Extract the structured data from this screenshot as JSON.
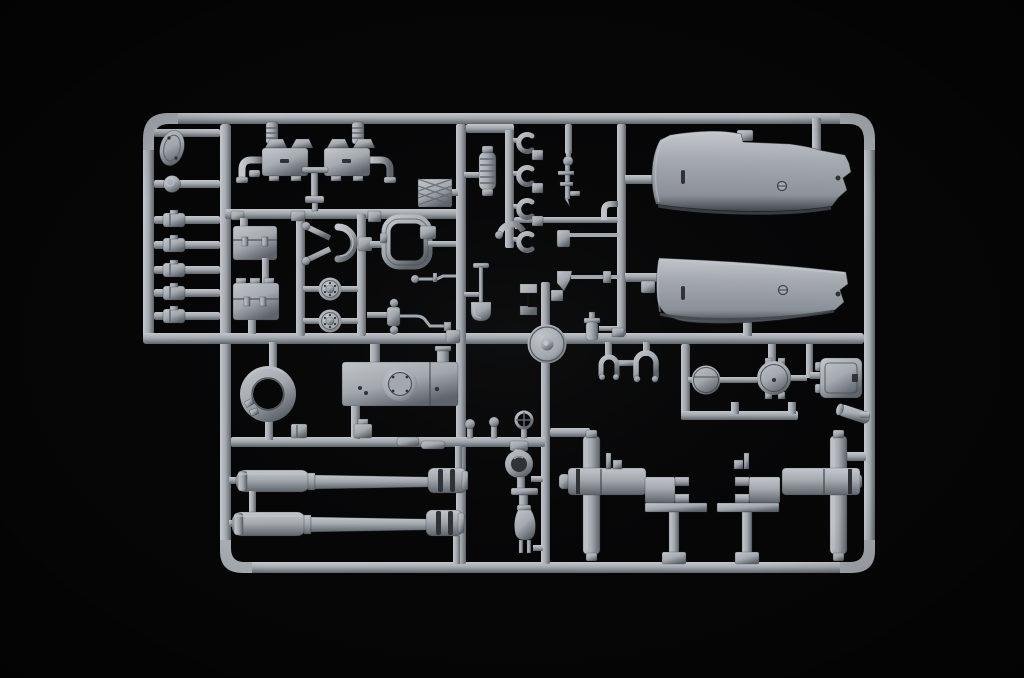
{
  "description": "Photograph of a light-grey injection-moulded model kit sprue (parts frame) on a black background",
  "palette": {
    "background": "#060607",
    "plastic_light": "#c6cacf",
    "plastic_base": "#a7acb2",
    "plastic_mid": "#8d939a",
    "plastic_dark": "#5f656c",
    "plastic_shadow": "#42474d",
    "recess": "#2f3338"
  },
  "parts": {
    "frame": {
      "label": "sprue runner frame"
    },
    "access_plate": {
      "label": "oval access plate"
    },
    "round_cap": {
      "label": "round cap"
    },
    "ladder_fittings": {
      "label": "row of small cylindrical fittings"
    },
    "muffler_left": {
      "label": "exhaust muffler with intake stacks and elbow pipe (left)"
    },
    "muffler_right": {
      "label": "exhaust muffler with intake stacks and elbow pipe (right)"
    },
    "tee_bracket": {
      "label": "T-shaped bracket"
    },
    "mesh_grille": {
      "label": "cross-hatched mesh grille"
    },
    "stowage_box_small": {
      "label": "stowage box (small)"
    },
    "stowage_box_large": {
      "label": "stowage box (large)"
    },
    "crescent_bracket": {
      "label": "crescent bracket with bolt arms"
    },
    "hatch_coaming": {
      "label": "rounded-square hatch coaming ring"
    },
    "road_wheels": {
      "label": "pair of bolted road wheels"
    },
    "linkage_rod": {
      "label": "thin linkage rod with ball end"
    },
    "ball_joint_lever": {
      "label": "ball-joint lever linkage"
    },
    "coil_spring": {
      "label": "ribbed coil spring cylinder"
    },
    "clamps": {
      "label": "set of four C-clamps"
    },
    "pump_tool": {
      "label": "hand pump tool"
    },
    "hammer_tool": {
      "label": "hammer tool on rod"
    },
    "axe_tool": {
      "label": "axe tool on rod"
    },
    "elbow_pipe_upper": {
      "label": "elbow pipe fitting (upper)"
    },
    "elbow_pipe_lower": {
      "label": "curved elbow fitting (lower)"
    },
    "filler_bottle": {
      "label": "filler cap bottle"
    },
    "shovel": {
      "label": "round-point shovel"
    },
    "step_bracket": {
      "label": "stepped Z bracket"
    },
    "dome_wheel": {
      "label": "domed wheel with centre cone"
    },
    "turret_shell_upper": {
      "label": "curved turret shell half (upper)"
    },
    "turret_shell_lower": {
      "label": "curved turret shell half (lower)"
    },
    "shackles": {
      "label": "pair of U-shackles"
    },
    "hatch_round_small": {
      "label": "round hatch lid (small)"
    },
    "hatch_round_large": {
      "label": "round hatch lid with hinges (large)"
    },
    "hatch_rectangular": {
      "label": "rectangular hatch door"
    },
    "smoke_launcher": {
      "label": "tilted smoke launcher tube"
    },
    "turret_ring": {
      "label": "large turret ring"
    },
    "drive_plate": {
      "label": "final drive mounting plate with round boss"
    },
    "ball_pegs": {
      "label": "ball-headed pegs"
    },
    "valve_wheel": {
      "label": "spoked valve handwheel"
    },
    "barrel_upper": {
      "label": "gun barrel with muzzle brake (upper)"
    },
    "barrel_lower": {
      "label": "gun barrel with muzzle brake (lower)"
    },
    "tool_blocks": {
      "label": "small gate blocks and tool lumps"
    },
    "mantlet_sleeve": {
      "label": "open mantlet sleeve cylinder"
    },
    "grip_column": {
      "label": "collar shaft and pistol-grip column"
    },
    "breech_left": {
      "label": "gun breech with recoil cylinder (left)"
    },
    "breech_right": {
      "label": "gun breech with recoil cylinder (right, mirrored)"
    }
  }
}
